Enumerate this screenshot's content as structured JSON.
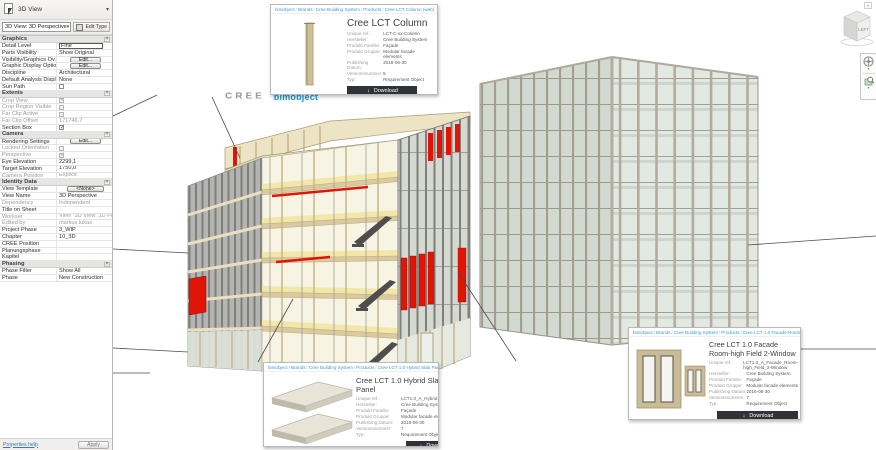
{
  "properties_panel": {
    "title": "3D View",
    "type_selector": "3D View: 3D Perspective",
    "edit_type_label": "Edit Type",
    "help_link": "Properties help",
    "apply_label": "Apply",
    "sections": [
      {
        "name": "Graphics",
        "rows": [
          {
            "label": "Detail Level",
            "value": "Fine",
            "type": "input"
          },
          {
            "label": "Parts Visibility",
            "value": "Show Original",
            "type": "text"
          },
          {
            "label": "Visibility/Graphics Ov...",
            "value": "Edit...",
            "type": "button"
          },
          {
            "label": "Graphic Display Optio...",
            "value": "Edit...",
            "type": "button"
          },
          {
            "label": "Discipline",
            "value": "Architectural",
            "type": "text"
          },
          {
            "label": "Default Analysis Displ...",
            "value": "None",
            "type": "text"
          },
          {
            "label": "Sun Path",
            "type": "checkbox",
            "checked": false
          }
        ]
      },
      {
        "name": "Extents",
        "rows": [
          {
            "label": "Crop View",
            "type": "checkbox",
            "checked": true,
            "disabled": true
          },
          {
            "label": "Crop Region Visible",
            "type": "checkbox",
            "checked": false,
            "disabled": true
          },
          {
            "label": "Far Clip Active",
            "type": "checkbox",
            "checked": false,
            "disabled": true
          },
          {
            "label": "Far Clip Offset",
            "value": "171746,7",
            "type": "text",
            "disabled": true
          },
          {
            "label": "Section Box",
            "type": "checkbox",
            "checked": true
          }
        ]
      },
      {
        "name": "Camera",
        "rows": [
          {
            "label": "Rendering Settings",
            "value": "Edit...",
            "type": "button"
          },
          {
            "label": "Locked Orientation",
            "type": "checkbox",
            "checked": false,
            "disabled": true
          },
          {
            "label": "Perspective",
            "type": "checkbox",
            "checked": true,
            "disabled": true
          },
          {
            "label": "Eye Elevation",
            "value": "2299,1",
            "type": "text"
          },
          {
            "label": "Target Elevation",
            "value": "1750,0",
            "type": "text"
          },
          {
            "label": "Camera Position",
            "value": "Explicit",
            "type": "text",
            "disabled": true
          }
        ]
      },
      {
        "name": "Identity Data",
        "rows": [
          {
            "label": "View Template",
            "value": "<None>",
            "type": "button"
          },
          {
            "label": "View Name",
            "value": "3D Perspective",
            "type": "text"
          },
          {
            "label": "Dependency",
            "value": "Independent",
            "type": "text",
            "disabled": true
          },
          {
            "label": "Title on Sheet",
            "value": "",
            "type": "text"
          },
          {
            "label": "Workset",
            "value": "View \"3D View: 3D Per...",
            "type": "text",
            "disabled": true
          },
          {
            "label": "Edited by",
            "value": "markus.lukas",
            "type": "text",
            "disabled": true
          },
          {
            "label": "Project Phase",
            "value": "3_WIP",
            "type": "text"
          },
          {
            "label": "Chapter",
            "value": "10_3D",
            "type": "text"
          },
          {
            "label": "CREE Position",
            "value": "",
            "type": "text"
          },
          {
            "label": "Planungsphase",
            "value": "",
            "type": "text"
          },
          {
            "label": "Kapitel",
            "value": "",
            "type": "text"
          }
        ]
      },
      {
        "name": "Phasing",
        "rows": [
          {
            "label": "Phase Filter",
            "value": "Show All",
            "type": "text"
          },
          {
            "label": "Phase",
            "value": "New Construction",
            "type": "text"
          }
        ]
      }
    ]
  },
  "viewport": {
    "viewcube_label": "LEFT",
    "logos": {
      "cree": "CREE",
      "bimobject": "bimobject"
    }
  },
  "breadcrumb_separator": "/",
  "cards": [
    {
      "breadcrumb": [
        "bimobject",
        "Brands",
        "Cree Building System",
        "Products",
        "Cree LCT Column (web)"
      ],
      "title": "Cree LCT Column",
      "fields": [
        [
          "Unique ref.:",
          "LCT-C-xx-Column"
        ],
        [
          "Hersteller:",
          "Cree Building System"
        ],
        [
          "Produkt Familie:",
          "Façade"
        ],
        [
          "Produkt Gruppe:",
          "Modular facade elements"
        ],
        [
          "Publishing Datum:",
          "2016-06-30"
        ],
        [
          "Versionsnummer:",
          "5"
        ],
        [
          "Typ:",
          "Requirement Object"
        ]
      ],
      "download_label": "Download"
    },
    {
      "breadcrumb": [
        "bimobject",
        "Brands",
        "Cree Building System",
        "Products",
        "Cree LCT 1.0 Hybrid Slab Panel (web)"
      ],
      "title": "Cree LCT 1.0 Hybrid Slab Panel",
      "fields": [
        [
          "Unique ref.:",
          "LCT1.0_A_Hybrid Slab Panel"
        ],
        [
          "Hersteller:",
          "Cree Building System"
        ],
        [
          "Produkt Familie:",
          "Façade"
        ],
        [
          "Produkt Gruppe:",
          "Modular facade elements"
        ],
        [
          "Publishing Datum:",
          "2016-06-30"
        ],
        [
          "Versionsnummer:",
          "7"
        ],
        [
          "Typ:",
          "Requirement Object"
        ]
      ],
      "download_label": "Download"
    },
    {
      "breadcrumb": [
        "bimobject",
        "Brands",
        "Cree Building System",
        "Products",
        "Cree LCT 1.0 Facade Room-high Field 2-Window (web)"
      ],
      "title": "Cree LCT 1.0 Facade Room-high Field 2-Window",
      "fields": [
        [
          "Unique ref.:",
          "LCT1.0_A_Facade_Room-high_Field_2-Window"
        ],
        [
          "Hersteller:",
          "Cree Building System"
        ],
        [
          "Produkt Familie:",
          "Façade"
        ],
        [
          "Produkt Gruppe:",
          "Modular facade elements"
        ],
        [
          "Publishing Datum:",
          "2016-06-30"
        ],
        [
          "Versionsnummer:",
          "7"
        ],
        [
          "Typ:",
          "Requirement Object"
        ]
      ],
      "download_label": "Download"
    }
  ],
  "colors": {
    "accent_red": "#e01407",
    "bimobject_blue": "#1693d0",
    "breadcrumb_blue": "#3a9bd5",
    "cream": "#efe6c0",
    "dark_button": "#2f3338"
  }
}
